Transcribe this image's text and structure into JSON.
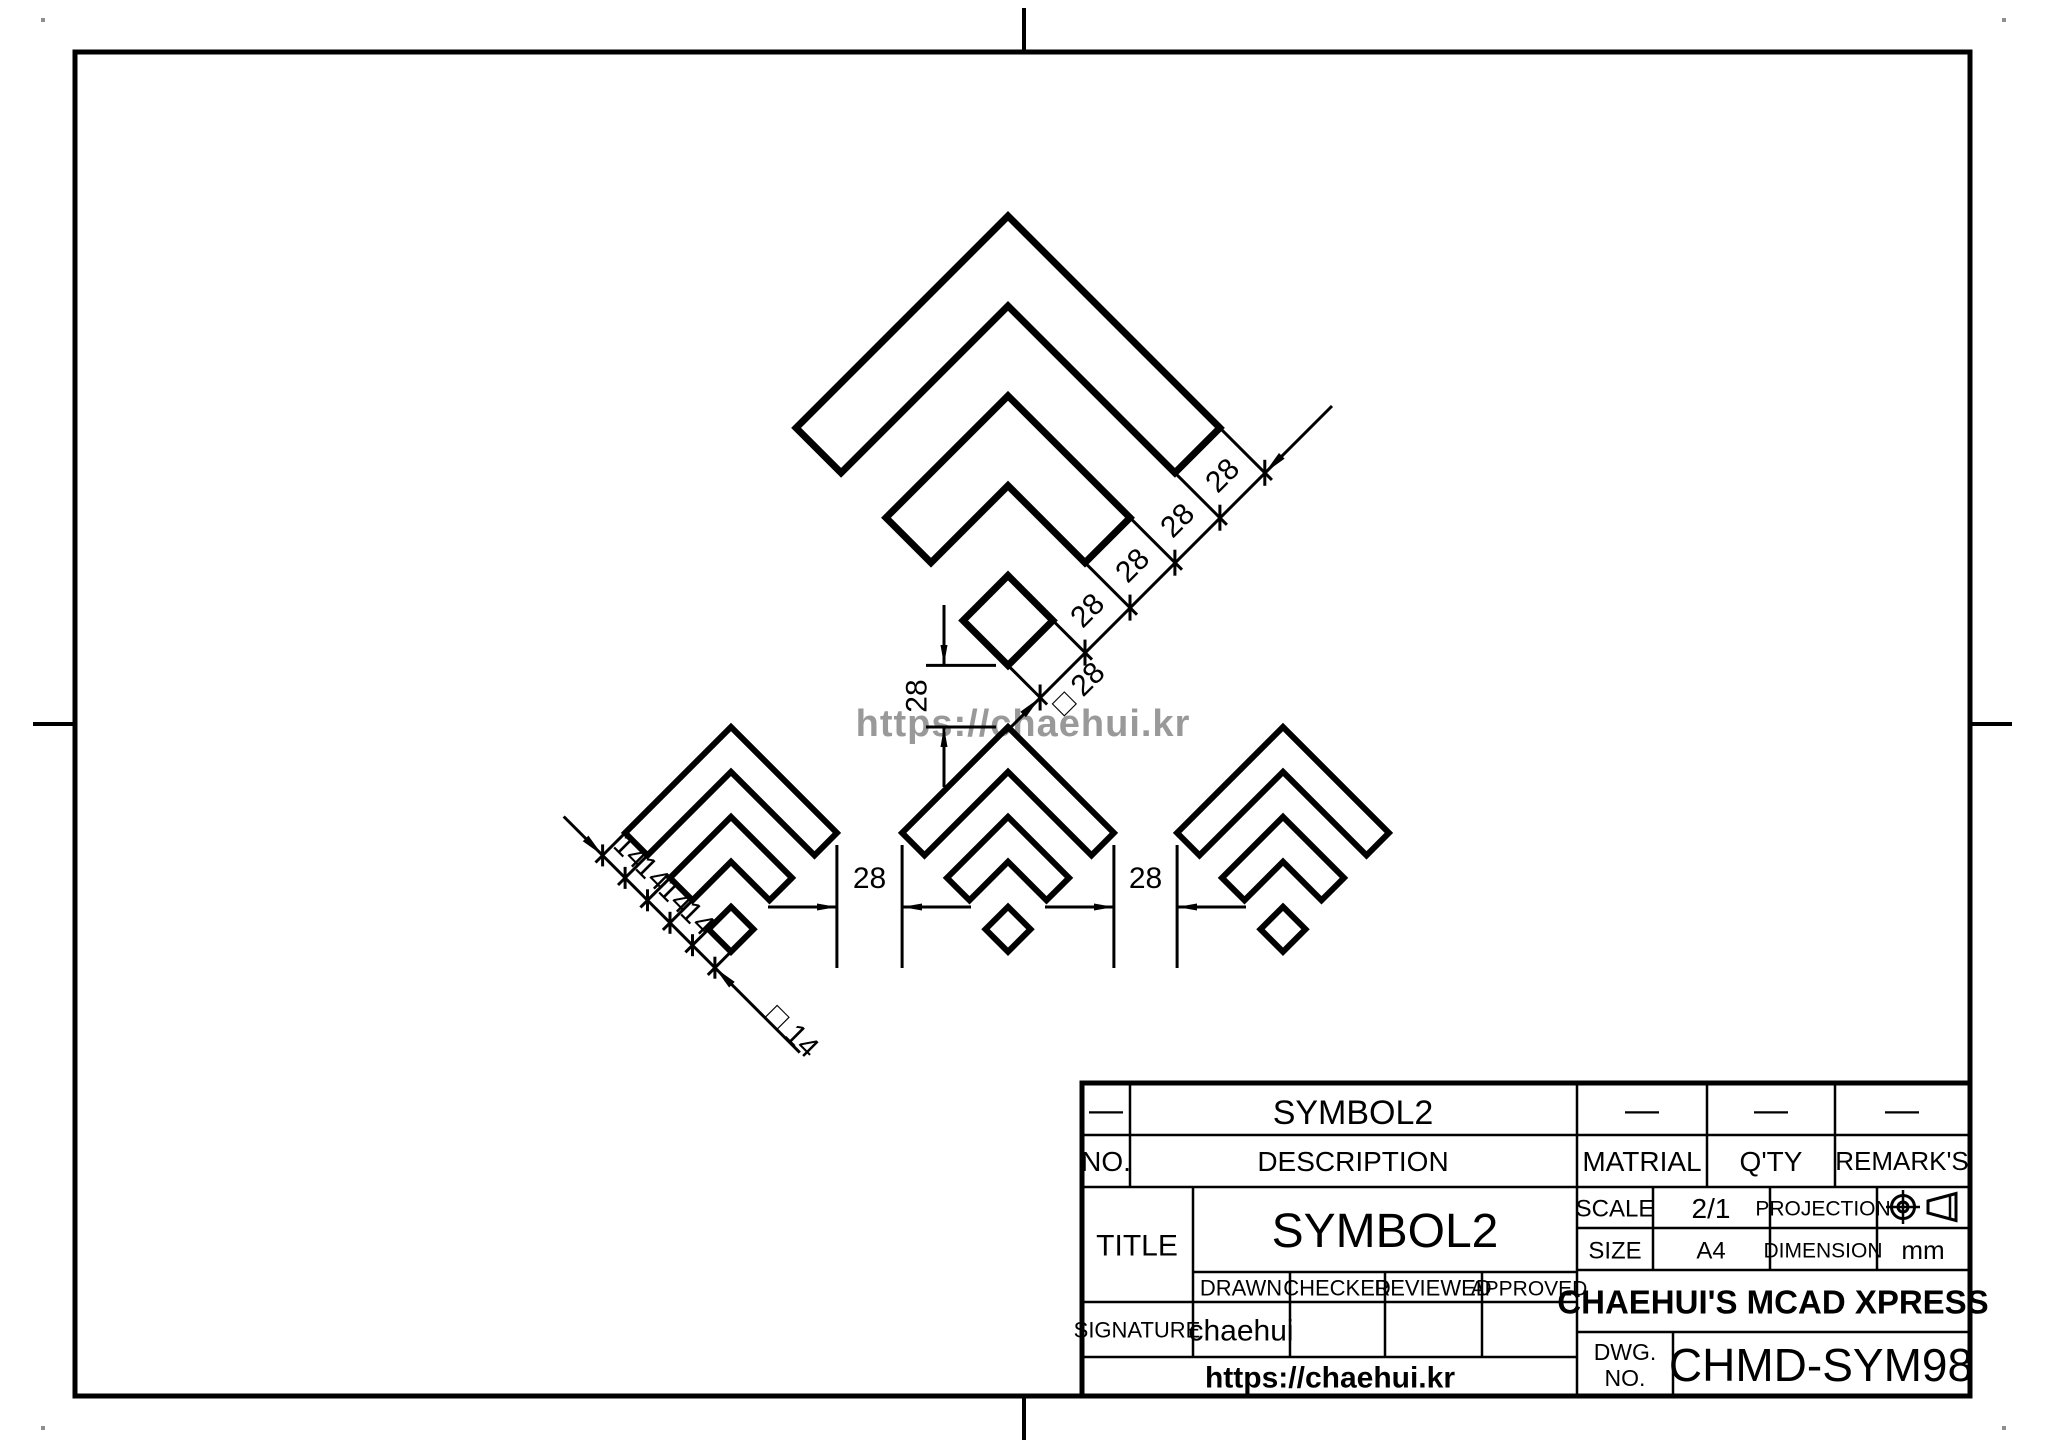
{
  "watermark": "https://chaehui.kr",
  "dimensions": {
    "large_chain": [
      "28",
      "28",
      "28",
      "28"
    ],
    "large_diamond": "□ 28",
    "small_chain": [
      "14",
      "14",
      "14",
      "14"
    ],
    "small_diamond": "□ 14",
    "gap_left": "28",
    "gap_right": "28",
    "vertical_gap": "28"
  },
  "title_block": {
    "rev_dash": "—",
    "rev_title": "SYMBOL2",
    "rev_material_dash": "—",
    "rev_qty_dash": "—",
    "rev_remark_dash": "—",
    "no_label": "NO.",
    "description_label": "DESCRIPTION",
    "material_label": "MATRIAL",
    "qty_label": "Q'TY",
    "remarks_label": "REMARK'S",
    "title_label": "TITLE",
    "title_value": "SYMBOL2",
    "scale_label": "SCALE",
    "scale_value": "2/1",
    "projection_label": "PROJECTION",
    "size_label": "SIZE",
    "size_value": "A4",
    "dimension_label": "DIMENSION",
    "dimension_value": "mm",
    "drawn_label": "DRAWN",
    "checked_label": "CHECKED",
    "reviewed_label": "REVIEWED",
    "approved_label": "APPROVED",
    "signature_label": "SIGNATURE",
    "drawn_value": "chaehui",
    "company": "CHAEHUI'S MCAD XPRESS",
    "url": "https://chaehui.kr",
    "dwg_label_line1": "DWG.",
    "dwg_label_line2": "NO.",
    "dwg_no": "CHMD-SYM98"
  }
}
